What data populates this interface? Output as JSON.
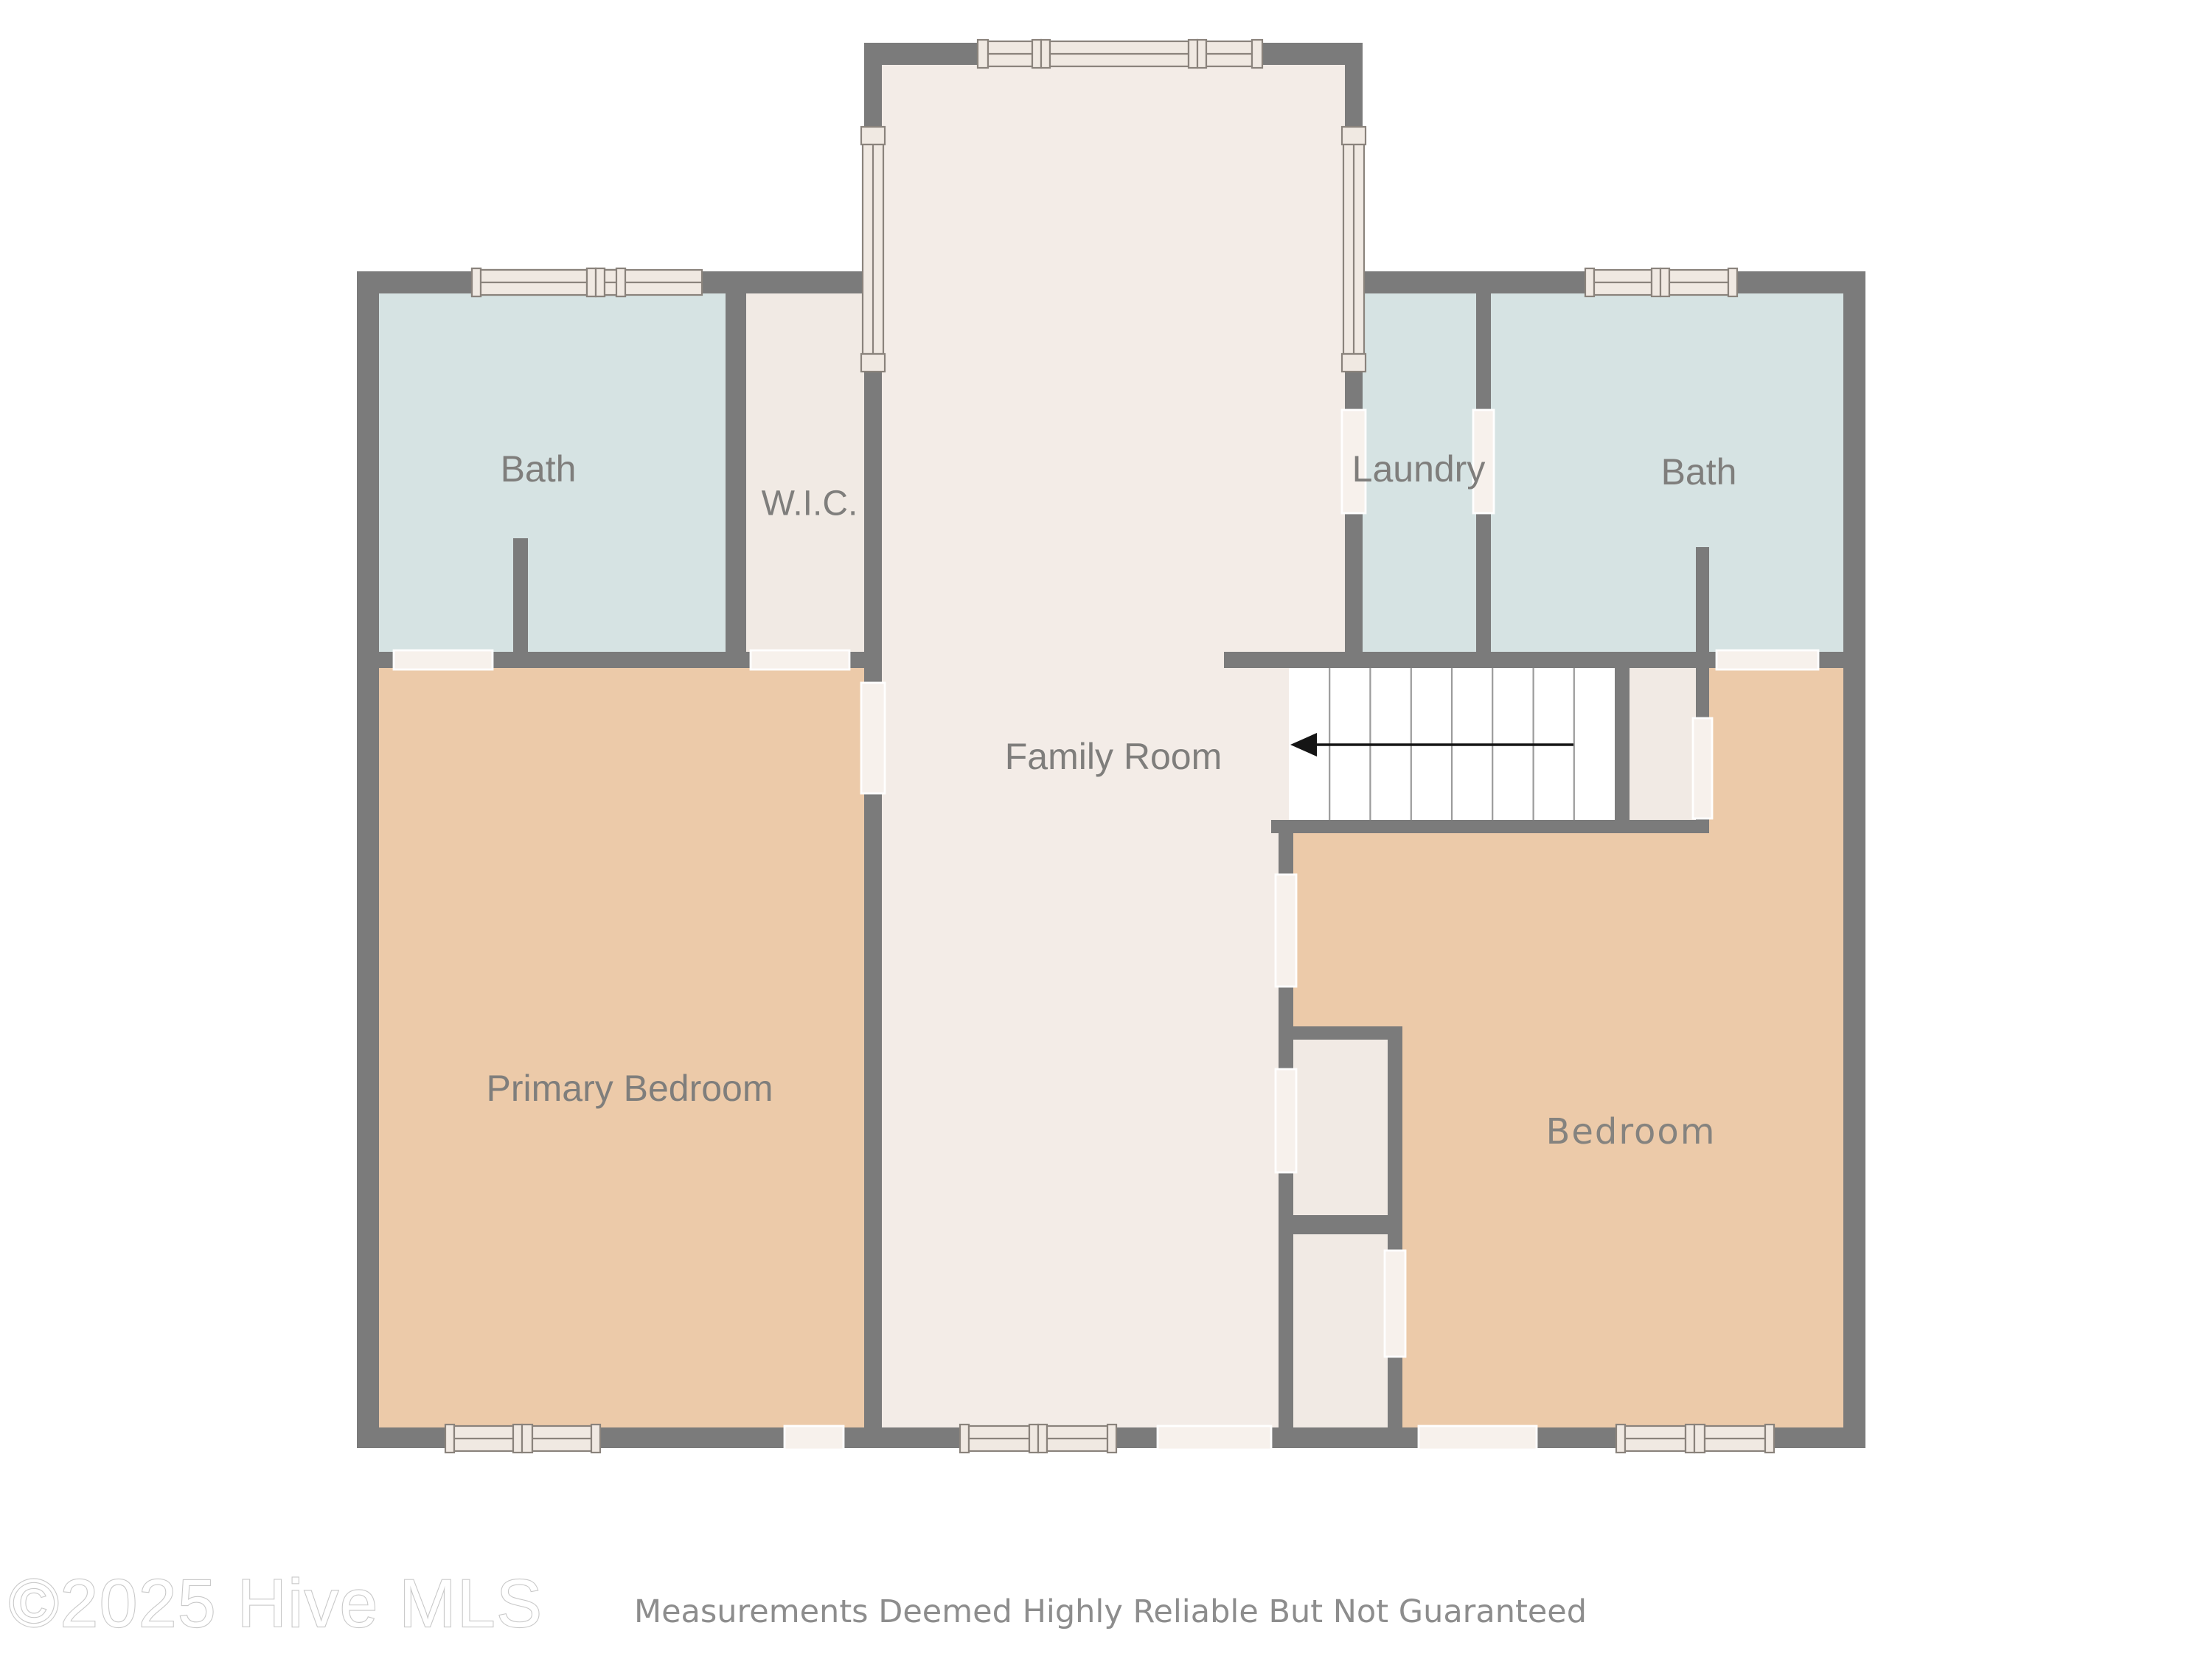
{
  "document": {
    "type": "floor-plan",
    "source_watermark": "©2025 Hive MLS",
    "disclaimer": "Measurements Deemed Highly Reliable But Not Guaranteed"
  },
  "rooms": {
    "bath_left": {
      "label": "Bath"
    },
    "wic": {
      "label": "W.I.C."
    },
    "laundry": {
      "label": "Laundry"
    },
    "bath_right": {
      "label": "Bath"
    },
    "family_room": {
      "label": "Family Room"
    },
    "primary_bedroom": {
      "label": "Primary Bedroom"
    },
    "bedroom": {
      "label": "Bedroom"
    }
  },
  "stairs": {
    "tread_columns": 8,
    "arrow_direction": "left"
  },
  "palette": {
    "wall": "#7b7b7b",
    "bath_floor": "#d6e3e3",
    "hall_floor": "#f3ece7",
    "closet_floor": "#f1eae4",
    "bedroom_floor": "#eccaa9",
    "stairs_floor": "#ffffff",
    "door_opening": "#f7f1ec",
    "window_fill": "#f0e9e2",
    "window_stroke": "#8a837c",
    "label_text": "#7f7e7c",
    "disclaimer_text": "#8d8d8d",
    "background": "#ffffff"
  }
}
